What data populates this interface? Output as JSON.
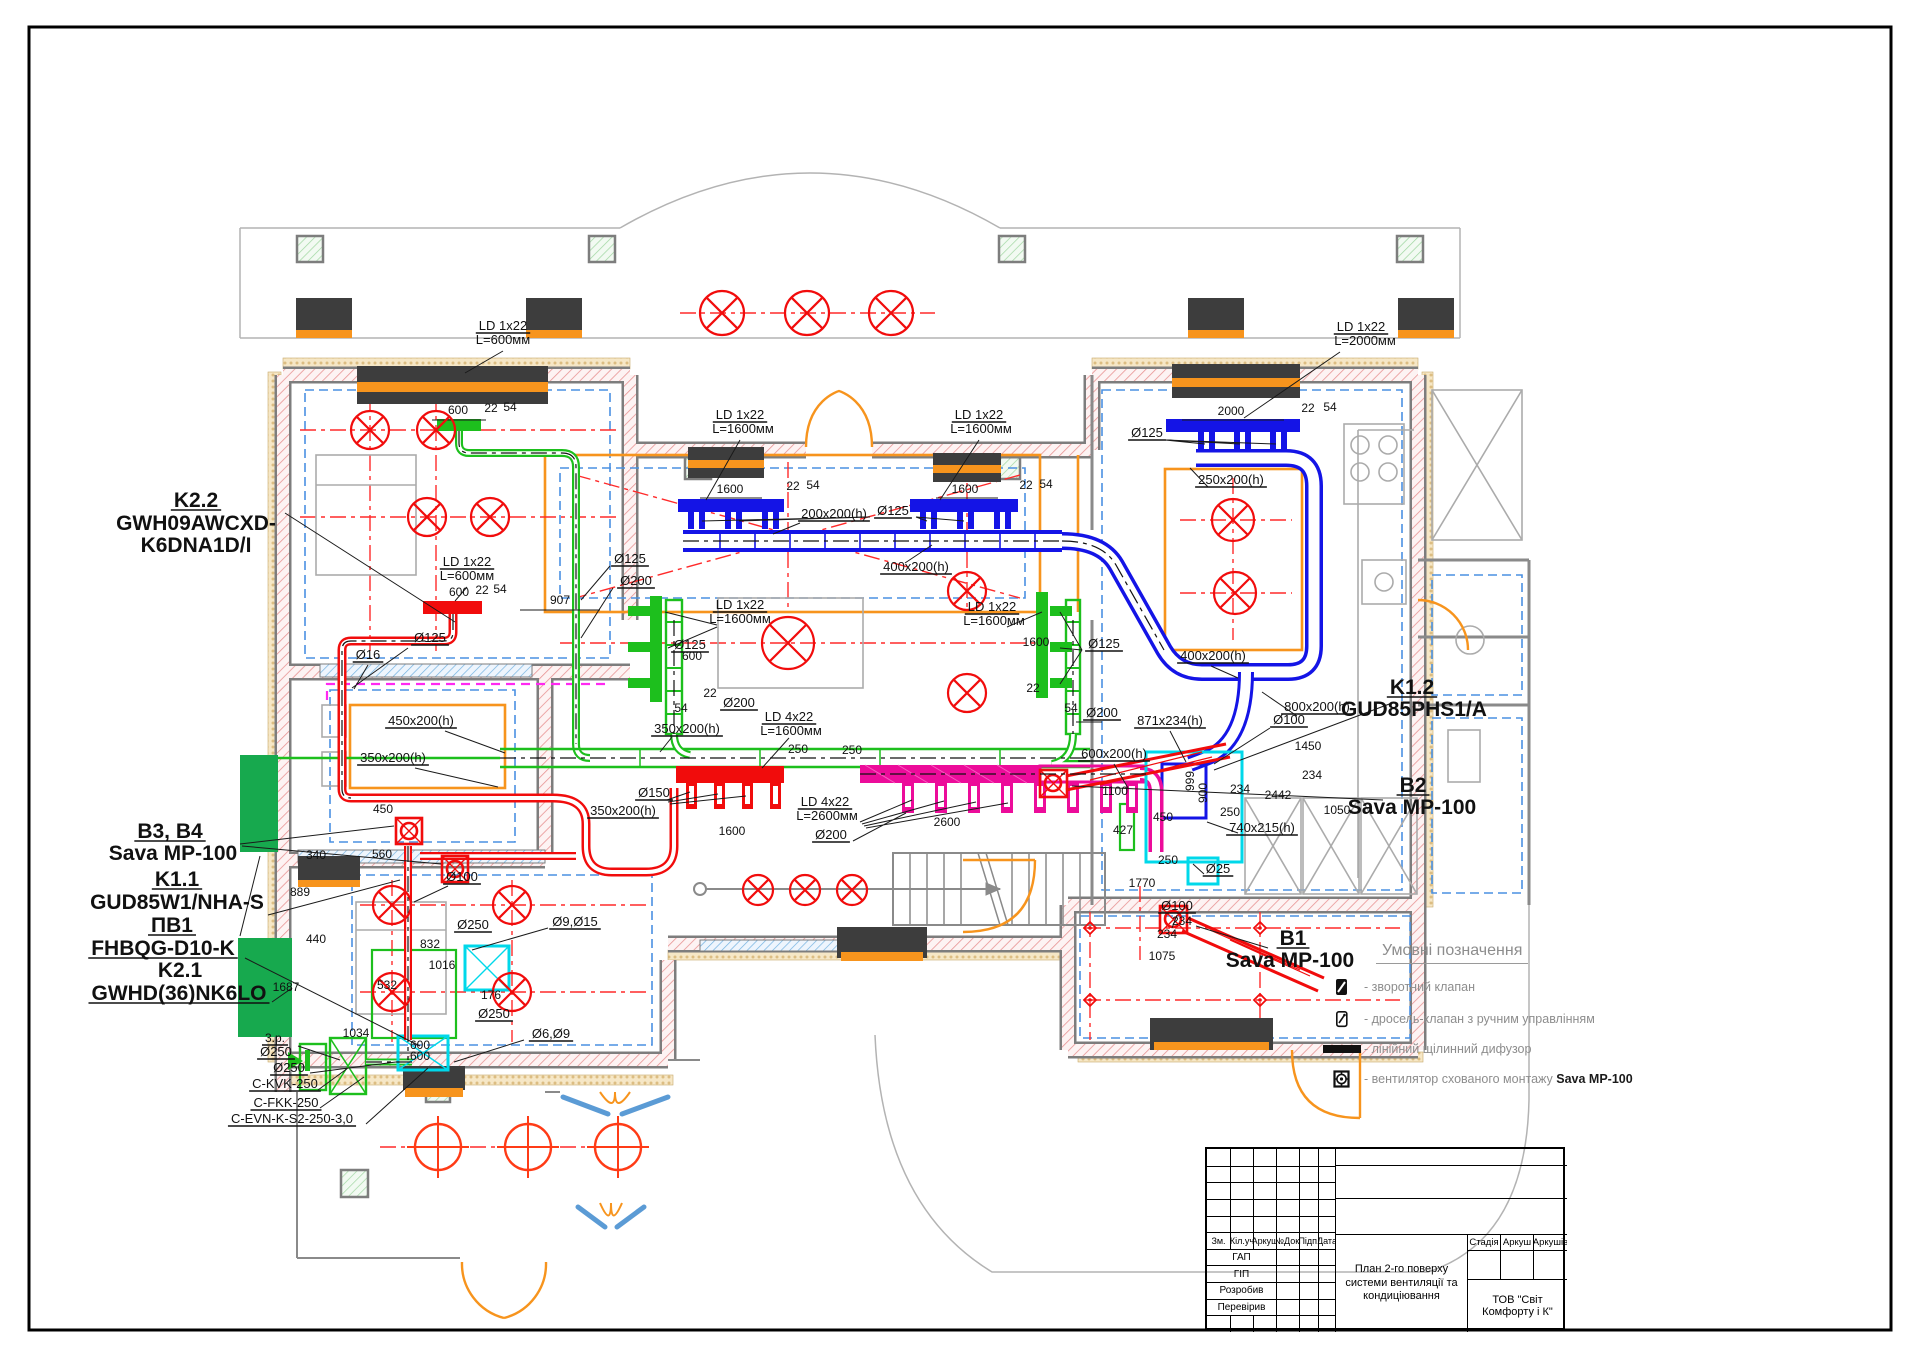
{
  "colors": {
    "red": "#f10c0c",
    "green": "#1dbf1d",
    "blue": "#1414e6",
    "magenta": "#ec0c9a",
    "orange": "#f7941d",
    "cyan": "#00d8ea",
    "wall": "#7d7d7d",
    "dim_text": "#111111"
  },
  "legend": {
    "title": "Умовні позначення",
    "items": [
      {
        "icon": "check-valve-icon",
        "text": "- зворотний клапан",
        "bold_part": ""
      },
      {
        "icon": "throttle-valve-icon",
        "text": "- дросель-клапан з ручним управлінням",
        "bold_part": ""
      },
      {
        "icon": "linear-diffuser-icon",
        "text": "- лінійний щілинний дифузор",
        "bold_part": ""
      },
      {
        "icon": "concealed-fan-icon",
        "text": "- вентилятор схованого монтажу ",
        "bold_part": "Sava MP-100"
      }
    ]
  },
  "title_block": {
    "columns": [
      "Зм.",
      "Кіл.уч",
      "Аркуш",
      "№Док.",
      "Підп.",
      "Дата"
    ],
    "rows": [
      "ГАП",
      "ГІП",
      "Розробив",
      "Перевірив"
    ],
    "drawing_title": "План 2-го поверху системи вентиляції та кондиціювання",
    "company": "ТОВ \"Світ Комфорту і К\"",
    "right_columns": [
      "Стадія",
      "Аркуш",
      "Аркушів"
    ]
  },
  "plan": {
    "fixtures_xcircle": [
      [
        722,
        313,
        22
      ],
      [
        807,
        313,
        22
      ],
      [
        891,
        313,
        22
      ],
      [
        370,
        430,
        19
      ],
      [
        436,
        430,
        19
      ],
      [
        427,
        517,
        19
      ],
      [
        490,
        517,
        19
      ],
      [
        788,
        643,
        26
      ],
      [
        967,
        591,
        19
      ],
      [
        967,
        693,
        19
      ],
      [
        1233,
        520,
        21
      ],
      [
        1235,
        593,
        21
      ],
      [
        392,
        905,
        19
      ],
      [
        512,
        905,
        19
      ],
      [
        392,
        992,
        19
      ],
      [
        512,
        992,
        19
      ],
      [
        758,
        890,
        15
      ],
      [
        805,
        890,
        15
      ],
      [
        852,
        890,
        15
      ]
    ],
    "fixtures_target": [
      [
        438,
        1147,
        23
      ],
      [
        528,
        1147,
        23
      ],
      [
        618,
        1147,
        23
      ]
    ],
    "fixtures_diamond": [
      [
        1090,
        928
      ],
      [
        1260,
        928
      ],
      [
        1090,
        1000
      ],
      [
        1260,
        1000
      ]
    ],
    "labels": [
      {
        "t": "K2.2",
        "x": 196,
        "y": 507,
        "s": 21,
        "b": 1,
        "u": 1
      },
      {
        "t": "GWH09AWCXD-",
        "x": 196,
        "y": 530,
        "s": 21,
        "b": 1
      },
      {
        "t": "K6DNA1D/I",
        "x": 196,
        "y": 552,
        "s": 21,
        "b": 1
      },
      {
        "t": "B3, B4",
        "x": 170,
        "y": 838,
        "s": 21,
        "b": 1,
        "u": 1
      },
      {
        "t": "Sava MP-100",
        "x": 173,
        "y": 860,
        "s": 21,
        "b": 1
      },
      {
        "t": "K1.1",
        "x": 177,
        "y": 886,
        "s": 21,
        "b": 1,
        "u": 1
      },
      {
        "t": "GUD85W1/NHA-S",
        "x": 177,
        "y": 909,
        "s": 21,
        "b": 1
      },
      {
        "t": "ПВ1",
        "x": 172,
        "y": 932,
        "s": 21,
        "b": 1,
        "u": 1
      },
      {
        "t": "FHBQG-D10-K",
        "x": 163,
        "y": 955,
        "s": 21,
        "b": 1,
        "u": 1
      },
      {
        "t": "K2.1",
        "x": 180,
        "y": 977,
        "s": 21,
        "b": 1
      },
      {
        "t": "GWHD(36)NK6LO",
        "x": 179,
        "y": 1000,
        "s": 21,
        "b": 1,
        "u": 1
      },
      {
        "t": "K1.2",
        "x": 1412,
        "y": 694,
        "s": 21,
        "b": 1,
        "u": 1
      },
      {
        "t": "GUD85PHS1/A",
        "x": 1414,
        "y": 716,
        "s": 21,
        "b": 1
      },
      {
        "t": "B2",
        "x": 1413,
        "y": 792,
        "s": 21,
        "b": 1,
        "u": 1
      },
      {
        "t": "Sava MP-100",
        "x": 1412,
        "y": 814,
        "s": 21,
        "b": 1
      },
      {
        "t": "B1",
        "x": 1293,
        "y": 945,
        "s": 21,
        "b": 1,
        "u": 1
      },
      {
        "t": "Sava MP-100",
        "x": 1290,
        "y": 967,
        "s": 21,
        "b": 1
      },
      {
        "t": "LD 1x22",
        "x": 503,
        "y": 330,
        "s": 13,
        "u": 1
      },
      {
        "t": "L=600мм",
        "x": 503,
        "y": 344,
        "s": 13
      },
      {
        "t": "LD 1x22",
        "x": 740,
        "y": 419,
        "s": 13,
        "u": 1
      },
      {
        "t": "L=1600мм",
        "x": 743,
        "y": 433,
        "s": 13
      },
      {
        "t": "LD 1x22",
        "x": 979,
        "y": 419,
        "s": 13,
        "u": 1
      },
      {
        "t": "L=1600мм",
        "x": 981,
        "y": 433,
        "s": 13
      },
      {
        "t": "LD 1x22",
        "x": 1361,
        "y": 331,
        "s": 13,
        "u": 1
      },
      {
        "t": "L=2000мм",
        "x": 1365,
        "y": 345,
        "s": 13
      },
      {
        "t": "LD 1x22",
        "x": 467,
        "y": 566,
        "s": 13,
        "u": 1
      },
      {
        "t": "L=600мм",
        "x": 467,
        "y": 580,
        "s": 13
      },
      {
        "t": "LD 1x22",
        "x": 740,
        "y": 609,
        "s": 13,
        "u": 1
      },
      {
        "t": "L=1600мм",
        "x": 740,
        "y": 623,
        "s": 13
      },
      {
        "t": "LD 1x22",
        "x": 992,
        "y": 611,
        "s": 13,
        "u": 1
      },
      {
        "t": "L=1600мм",
        "x": 994,
        "y": 625,
        "s": 13
      },
      {
        "t": "LD 4x22",
        "x": 789,
        "y": 721,
        "s": 13,
        "u": 1
      },
      {
        "t": "L=1600мм",
        "x": 791,
        "y": 735,
        "s": 13
      },
      {
        "t": "LD 4x22",
        "x": 825,
        "y": 806,
        "s": 13,
        "u": 1
      },
      {
        "t": "L=2600мм",
        "x": 827,
        "y": 820,
        "s": 13
      },
      {
        "t": "600",
        "x": 458,
        "y": 414
      },
      {
        "t": "22",
        "x": 491,
        "y": 412
      },
      {
        "t": "54",
        "x": 510,
        "y": 411
      },
      {
        "t": "1600",
        "x": 730,
        "y": 493
      },
      {
        "t": "22",
        "x": 793,
        "y": 490
      },
      {
        "t": "54",
        "x": 813,
        "y": 489
      },
      {
        "t": "1600",
        "x": 965,
        "y": 493
      },
      {
        "t": "22",
        "x": 1026,
        "y": 489
      },
      {
        "t": "54",
        "x": 1046,
        "y": 488
      },
      {
        "t": "2000",
        "x": 1231,
        "y": 415
      },
      {
        "t": "22",
        "x": 1308,
        "y": 412
      },
      {
        "t": "54",
        "x": 1330,
        "y": 411
      },
      {
        "t": "600",
        "x": 459,
        "y": 596
      },
      {
        "t": "22",
        "x": 482,
        "y": 594
      },
      {
        "t": "54",
        "x": 500,
        "y": 593
      },
      {
        "t": "907",
        "x": 560,
        "y": 604
      },
      {
        "t": "600",
        "x": 692,
        "y": 660
      },
      {
        "t": "22",
        "x": 710,
        "y": 697
      },
      {
        "t": "54",
        "x": 681,
        "y": 712
      },
      {
        "t": "1600",
        "x": 1036,
        "y": 646
      },
      {
        "t": "22",
        "x": 1033,
        "y": 692
      },
      {
        "t": "54",
        "x": 1071,
        "y": 712
      },
      {
        "t": "250",
        "x": 798,
        "y": 753
      },
      {
        "t": "250",
        "x": 852,
        "y": 754
      },
      {
        "t": "1600",
        "x": 732,
        "y": 835
      },
      {
        "t": "2600",
        "x": 947,
        "y": 826
      },
      {
        "t": "450",
        "x": 383,
        "y": 813
      },
      {
        "t": "560",
        "x": 382,
        "y": 858
      },
      {
        "t": "340",
        "x": 316,
        "y": 859
      },
      {
        "t": "889",
        "x": 300,
        "y": 896
      },
      {
        "t": "440",
        "x": 316,
        "y": 943
      },
      {
        "t": "832",
        "x": 430,
        "y": 948
      },
      {
        "t": "1016",
        "x": 442,
        "y": 969
      },
      {
        "t": "532",
        "x": 387,
        "y": 989
      },
      {
        "t": "1687",
        "x": 286,
        "y": 991
      },
      {
        "t": "176",
        "x": 491,
        "y": 999
      },
      {
        "t": "600",
        "x": 420,
        "y": 1049
      },
      {
        "t": "600",
        "x": 420,
        "y": 1060
      },
      {
        "t": "1034",
        "x": 356,
        "y": 1037
      },
      {
        "t": "1450",
        "x": 1308,
        "y": 750
      },
      {
        "t": "234",
        "x": 1312,
        "y": 779
      },
      {
        "t": "234",
        "x": 1240,
        "y": 793
      },
      {
        "t": "2442",
        "x": 1278,
        "y": 799
      },
      {
        "t": "1050",
        "x": 1337,
        "y": 814
      },
      {
        "t": "1100",
        "x": 1115,
        "y": 795
      },
      {
        "t": "450",
        "x": 1163,
        "y": 821
      },
      {
        "t": "427",
        "x": 1123,
        "y": 834
      },
      {
        "t": "250",
        "x": 1230,
        "y": 816
      },
      {
        "t": "250",
        "x": 1168,
        "y": 864
      },
      {
        "t": "1770",
        "x": 1142,
        "y": 887
      },
      {
        "t": "234",
        "x": 1182,
        "y": 925
      },
      {
        "t": "234",
        "x": 1167,
        "y": 938
      },
      {
        "t": "1075",
        "x": 1162,
        "y": 960
      },
      {
        "t": "999",
        "x": 1194,
        "y": 781,
        "r": -90
      },
      {
        "t": "900",
        "x": 1207,
        "y": 793,
        "r": -90
      },
      {
        "t": "Ø125",
        "x": 630,
        "y": 563,
        "s": 13,
        "u": 1
      },
      {
        "t": "Ø200",
        "x": 636,
        "y": 585,
        "s": 13,
        "u": 1
      },
      {
        "t": "Ø125",
        "x": 430,
        "y": 642,
        "s": 13,
        "u": 1
      },
      {
        "t": "Ø16",
        "x": 368,
        "y": 659,
        "s": 13,
        "u": 1
      },
      {
        "t": "Ø125",
        "x": 690,
        "y": 649,
        "s": 13,
        "u": 1
      },
      {
        "t": "Ø200",
        "x": 739,
        "y": 707,
        "s": 13,
        "u": 1
      },
      {
        "t": "Ø125",
        "x": 893,
        "y": 515,
        "s": 13,
        "u": 1
      },
      {
        "t": "Ø125",
        "x": 1147,
        "y": 437,
        "s": 13,
        "u": 1
      },
      {
        "t": "Ø125",
        "x": 1104,
        "y": 648,
        "s": 13,
        "u": 1
      },
      {
        "t": "Ø200",
        "x": 1102,
        "y": 717,
        "s": 13,
        "u": 1
      },
      {
        "t": "Ø150",
        "x": 654,
        "y": 797,
        "s": 13,
        "u": 1
      },
      {
        "t": "Ø200",
        "x": 831,
        "y": 839,
        "s": 13,
        "u": 1
      },
      {
        "t": "Ø100",
        "x": 462,
        "y": 881,
        "s": 13,
        "u": 1
      },
      {
        "t": "Ø250",
        "x": 473,
        "y": 929,
        "s": 13,
        "u": 1
      },
      {
        "t": "Ø9,Ø15",
        "x": 575,
        "y": 926,
        "s": 13,
        "u": 1
      },
      {
        "t": "Ø250",
        "x": 494,
        "y": 1018,
        "s": 13,
        "u": 1
      },
      {
        "t": "Ø6,Ø9",
        "x": 551,
        "y": 1038,
        "s": 13,
        "u": 1
      },
      {
        "t": "Ø250",
        "x": 276,
        "y": 1056,
        "s": 13,
        "u": 1
      },
      {
        "t": "Ø250",
        "x": 289,
        "y": 1072,
        "s": 13,
        "u": 1
      },
      {
        "t": "Ø100",
        "x": 1289,
        "y": 724,
        "s": 13,
        "u": 1
      },
      {
        "t": "Ø25",
        "x": 1218,
        "y": 873,
        "s": 13,
        "u": 1
      },
      {
        "t": "Ø100",
        "x": 1177,
        "y": 910,
        "s": 13,
        "u": 1
      },
      {
        "t": "450x200(h)",
        "x": 421,
        "y": 725,
        "s": 13,
        "u": 1
      },
      {
        "t": "350x200(h)",
        "x": 393,
        "y": 762,
        "s": 13,
        "u": 1
      },
      {
        "t": "350x200(h)",
        "x": 687,
        "y": 733,
        "s": 13,
        "u": 1
      },
      {
        "t": "350x200(h)",
        "x": 623,
        "y": 815,
        "s": 13,
        "u": 1
      },
      {
        "t": "200x200(h)",
        "x": 834,
        "y": 518,
        "s": 13,
        "u": 1
      },
      {
        "t": "400x200(h)",
        "x": 916,
        "y": 571,
        "s": 13,
        "u": 1
      },
      {
        "t": "400x200(h)",
        "x": 1213,
        "y": 660,
        "s": 13,
        "u": 1
      },
      {
        "t": "250x200(h)",
        "x": 1231,
        "y": 484,
        "s": 13,
        "u": 1
      },
      {
        "t": "800x200(h)",
        "x": 1317,
        "y": 711,
        "s": 13,
        "u": 1
      },
      {
        "t": "871x234(h)",
        "x": 1170,
        "y": 725,
        "s": 13,
        "u": 1
      },
      {
        "t": "600x200(h)",
        "x": 1114,
        "y": 758,
        "s": 13,
        "u": 1
      },
      {
        "t": "740x215(h)",
        "x": 1262,
        "y": 832,
        "s": 13,
        "u": 1
      },
      {
        "t": "3.р.",
        "x": 275,
        "y": 1042,
        "u": 1
      },
      {
        "t": "C-KVK-250",
        "x": 285,
        "y": 1088,
        "s": 13,
        "u": 1
      },
      {
        "t": "C-FKK-250",
        "x": 286,
        "y": 1107,
        "s": 13,
        "u": 1
      },
      {
        "t": "C-EVN-K-S2-250-3,0",
        "x": 292,
        "y": 1123,
        "s": 13,
        "u": 1
      }
    ]
  }
}
